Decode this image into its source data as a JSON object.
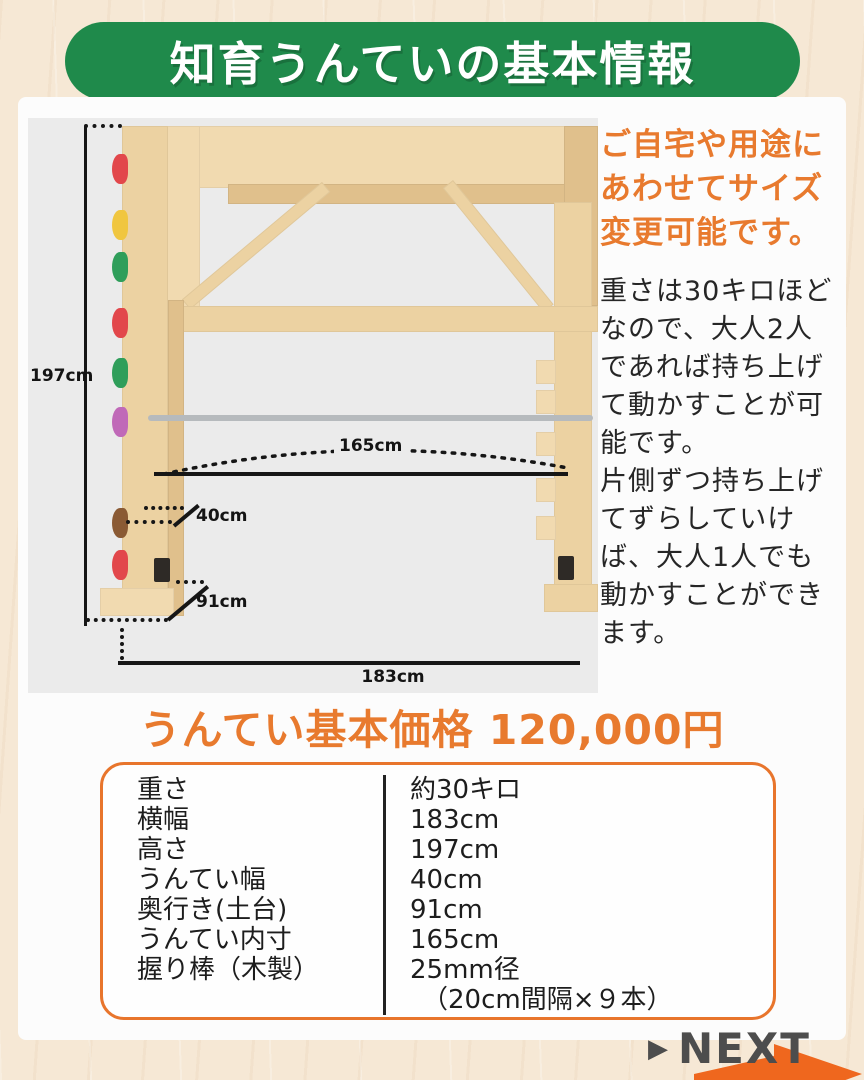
{
  "header": {
    "title": "知育うんていの基本情報"
  },
  "colors": {
    "green": "#1f8a4b",
    "orange": "#e87a2e",
    "table_border": "#e8752c",
    "arrow_orange": "#ef671e"
  },
  "diagram": {
    "labels": {
      "height": "197cm",
      "inner_width": "165cm",
      "ladder_width": "40cm",
      "base_depth": "91cm",
      "total_width": "183cm"
    },
    "holds": [
      {
        "name": "climbing-hold-red",
        "color": "#e2474b",
        "y": 36
      },
      {
        "name": "climbing-hold-yellow",
        "color": "#f0c63f",
        "y": 92
      },
      {
        "name": "climbing-hold-green",
        "color": "#2f9e5a",
        "y": 134
      },
      {
        "name": "climbing-hold-red",
        "color": "#e2474b",
        "y": 190
      },
      {
        "name": "climbing-hold-green",
        "color": "#2f9e5a",
        "y": 240
      },
      {
        "name": "climbing-hold-purple",
        "color": "#c069b8",
        "y": 289
      },
      {
        "name": "climbing-hold-brown",
        "color": "#8a5a34",
        "y": 390
      },
      {
        "name": "climbing-hold-red",
        "color": "#e2474b",
        "y": 432
      }
    ]
  },
  "info": {
    "highlight_lines": [
      "ご自宅や用途に",
      "あわせてサイズ",
      "変更可能です。"
    ],
    "body_lines": [
      "重さは30キロほど",
      "なので、大人2人",
      "であれば持ち上げ",
      "て動かすことが可",
      "能です。",
      "片側ずつ持ち上げ",
      "てずらしていけ",
      "ば、大人1人でも",
      "動かすことができ",
      "ます。"
    ]
  },
  "price": {
    "heading": "うんてい基本価格 120,000円"
  },
  "spec_table": {
    "rows": [
      {
        "label": "重さ",
        "value": "約30キロ"
      },
      {
        "label": "横幅",
        "value": "183cm"
      },
      {
        "label": "高さ",
        "value": "197cm"
      },
      {
        "label": "うんてい幅",
        "value": "40cm"
      },
      {
        "label": "奥行き(土台)",
        "value": "91cm"
      },
      {
        "label": "うんてい内寸",
        "value": "165cm"
      },
      {
        "label": "握り棒（木製）",
        "value": "25mm径",
        "value2": "（20cm間隔×９本）"
      }
    ]
  },
  "footer": {
    "next_label": "NEXT",
    "arrow_icon": "▶"
  }
}
